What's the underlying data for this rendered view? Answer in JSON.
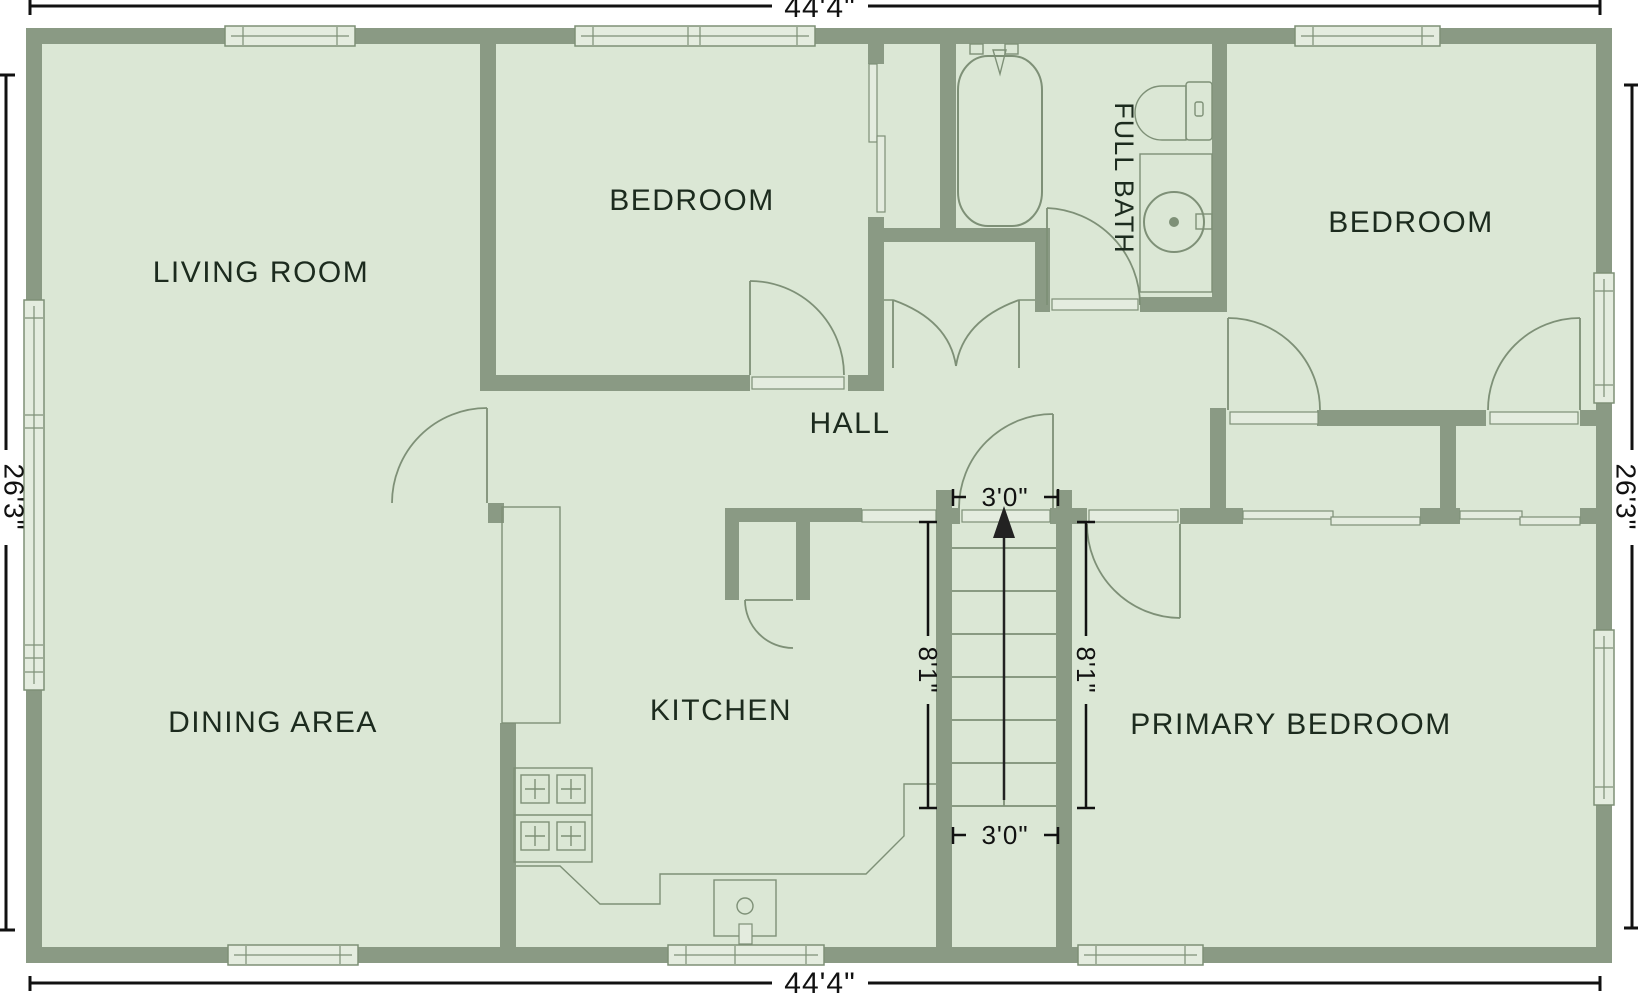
{
  "type": "floor_plan",
  "colors": {
    "wall": "#8a9a84",
    "floor": "#dbe7d5",
    "fixture_line": "#7e9077",
    "window_fill": "#e4ecdf",
    "label_text": "#1c2b1e",
    "dimension_text": "#111111",
    "background": "#ffffff"
  },
  "rooms": {
    "living_room": {
      "label": "LIVING ROOM"
    },
    "bedroom_top": {
      "label": "BEDROOM"
    },
    "bedroom_right": {
      "label": "BEDROOM"
    },
    "full_bath": {
      "label": "FULL BATH"
    },
    "hall": {
      "label": "HALL"
    },
    "dining_area": {
      "label": "DINING AREA"
    },
    "kitchen": {
      "label": "KITCHEN"
    },
    "primary_bedroom": {
      "label": "PRIMARY BEDROOM"
    }
  },
  "dimensions": {
    "overall_width_top": "44'4\"",
    "overall_width_bottom": "44'4\"",
    "overall_depth_left": "26'3\"",
    "overall_depth_right": "26'3\"",
    "stair_width_top": "3'0\"",
    "stair_width_bottom": "3'0\"",
    "stair_run_left": "8'1\"",
    "stair_run_right": "8'1\""
  },
  "stairs": {
    "direction_arrow": "up"
  },
  "fixtures": {
    "bathtub": "bathtub",
    "toilet": "toilet",
    "bathroom_vanity_sink": "round sink on vanity",
    "kitchen_sink": "single-basin sink",
    "stove": "4-burner range",
    "counters": "kitchen counter",
    "closet_doors": "sliding and double doors"
  }
}
